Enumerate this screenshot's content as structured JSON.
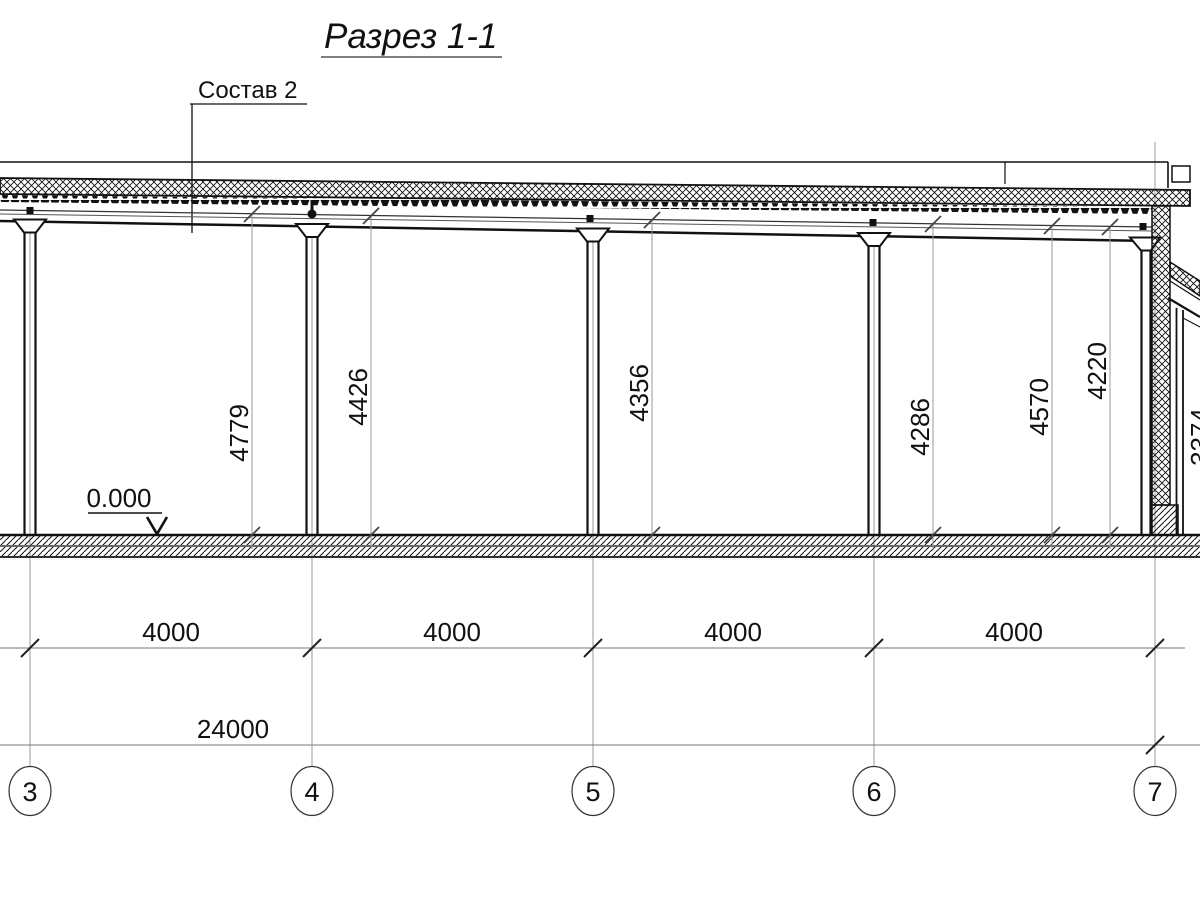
{
  "drawing": {
    "title": "Разрез 1-1",
    "callout_label": "Состав 2",
    "level_mark": "0.000",
    "colors": {
      "line": "#111111",
      "thin_line": "#8f8f8f",
      "background": "#ffffff"
    }
  },
  "vertical_dimensions": [
    {
      "value": "4779"
    },
    {
      "value": "4426"
    },
    {
      "value": "4356"
    },
    {
      "value": "4286"
    },
    {
      "value": "4570"
    },
    {
      "value": "4220"
    },
    {
      "value": "3374"
    }
  ],
  "bay_dimensions": [
    {
      "value": "4000"
    },
    {
      "value": "4000"
    },
    {
      "value": "4000"
    },
    {
      "value": "4000"
    }
  ],
  "total_dimension": {
    "value": "24000"
  },
  "axis_markers": [
    {
      "label": "3"
    },
    {
      "label": "4"
    },
    {
      "label": "5"
    },
    {
      "label": "6"
    },
    {
      "label": "7"
    }
  ]
}
